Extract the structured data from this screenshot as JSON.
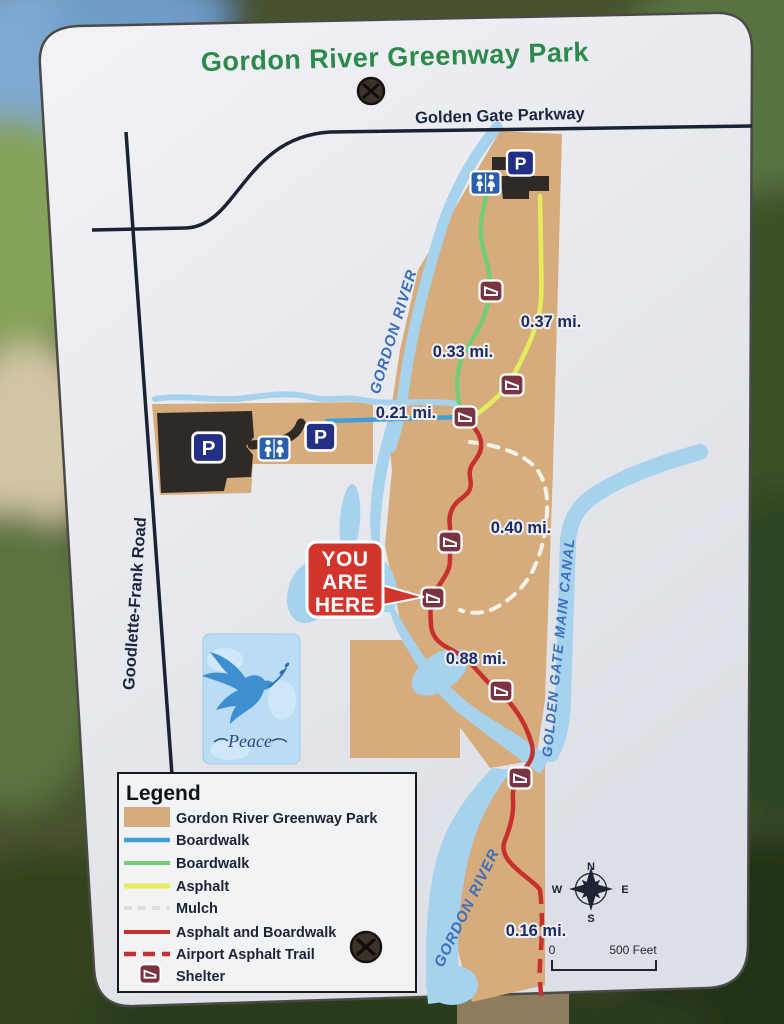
{
  "sign": {
    "title": "Gordon River Greenway Park",
    "roads": {
      "parkway": "Golden Gate Parkway",
      "west_road": "Goodlette-Frank Road"
    },
    "waterways": {
      "river_north": "GORDON RIVER",
      "river_south": "GORDON RIVER",
      "canal": "GOLDEN GATE MAIN CANAL"
    },
    "you_are_here": {
      "lines": [
        "YOU",
        "ARE",
        "HERE"
      ]
    },
    "distances": [
      "0.37 mi.",
      "0.33 mi.",
      "0.21 mi.",
      "0.40 mi.",
      "0.88 mi.",
      "0.16 mi."
    ],
    "icons": {
      "parking_letter": "P"
    },
    "compass": {
      "north": "N",
      "east": "E",
      "south": "S",
      "west": "W"
    },
    "scale_bar": {
      "start": "0",
      "end": "500 Feet"
    },
    "sticker": {
      "label": "Peace"
    },
    "legend": {
      "title": "Legend",
      "items": [
        {
          "label": "Gordon River Greenway Park",
          "swatch": "park-area"
        },
        {
          "label": "Boardwalk",
          "swatch": "line-blue"
        },
        {
          "label": "Boardwalk",
          "swatch": "line-green"
        },
        {
          "label": "Asphalt",
          "swatch": "line-yellow"
        },
        {
          "label": "Mulch",
          "swatch": "line-white-dashed"
        },
        {
          "label": "Asphalt and Boardwalk",
          "swatch": "line-red"
        },
        {
          "label": "Airport Asphalt Trail",
          "swatch": "line-red-dashed"
        },
        {
          "label": "Shelter",
          "swatch": "shelter-icon"
        }
      ]
    }
  },
  "colors": {
    "park_tan": "#d7ac7c",
    "water_blue": "#a6d2ee",
    "boardwalk_blue": "#3f9fd8",
    "boardwalk_green": "#74cc74",
    "asphalt_yellow": "#e6ec5e",
    "mulch_white": "#f4f3ea",
    "asphalt_boardwalk_red": "#c8302e",
    "airport_trail_red": "#c8302e",
    "shelter_maroon": "#7a3340",
    "parking_sign_blue": "#232f85",
    "restroom_sign_blue": "#2a5fae",
    "title_green": "#2c8a4a",
    "label_navy": "#1e2a66",
    "water_label_blue": "#3b6fbe",
    "road_black": "#1b2233",
    "you_are_here_red": "#d2352b"
  }
}
